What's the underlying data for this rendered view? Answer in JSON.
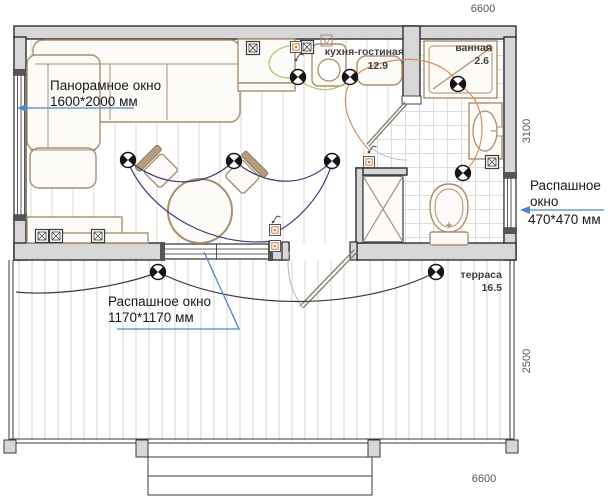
{
  "plan": {
    "dimensions": {
      "top": "6600",
      "side_house": "3100",
      "side_terrace": "2500",
      "bottom": "6600"
    },
    "rooms": {
      "kitchen_living": {
        "name": "кухня-гостиная",
        "area": "12.9"
      },
      "bathroom": {
        "name": "ванная",
        "area": "2.6"
      },
      "terrace": {
        "name": "терраса",
        "area": "16.5"
      }
    },
    "annotations": {
      "panoramic_window": {
        "line1": "Панорамное окно",
        "line2": "1600*2000 мм"
      },
      "casement_window_small": {
        "line1": "Распашное",
        "line2": "окно",
        "line3": "470*470 мм"
      },
      "casement_window_large": {
        "line1": "Распашное окно",
        "line2": "1170*1170 мм"
      }
    },
    "symbols": {
      "ceiling_light": "circle with opposite filled quadrants",
      "outlet_double": "square with X",
      "outlet_power": "square with center dot",
      "switch": "wall squiggle"
    },
    "colors": {
      "wall_fill": "#d7d7d7",
      "wall_stroke": "#2d2d2d",
      "furniture_stroke": "#a98f6f",
      "furniture_fill": "#fdfbf7",
      "wire_living": "#3d3d73",
      "wire_kitchen": "#a8cd7c",
      "wire_bathroom": "#d98e58",
      "wire_terrace": "#3a3a3a",
      "annotation_blue": "#4f88c7",
      "floor_line": "#ddd8d0",
      "tile_line": "#dcdcdc",
      "dim_text": "#58585a"
    }
  }
}
